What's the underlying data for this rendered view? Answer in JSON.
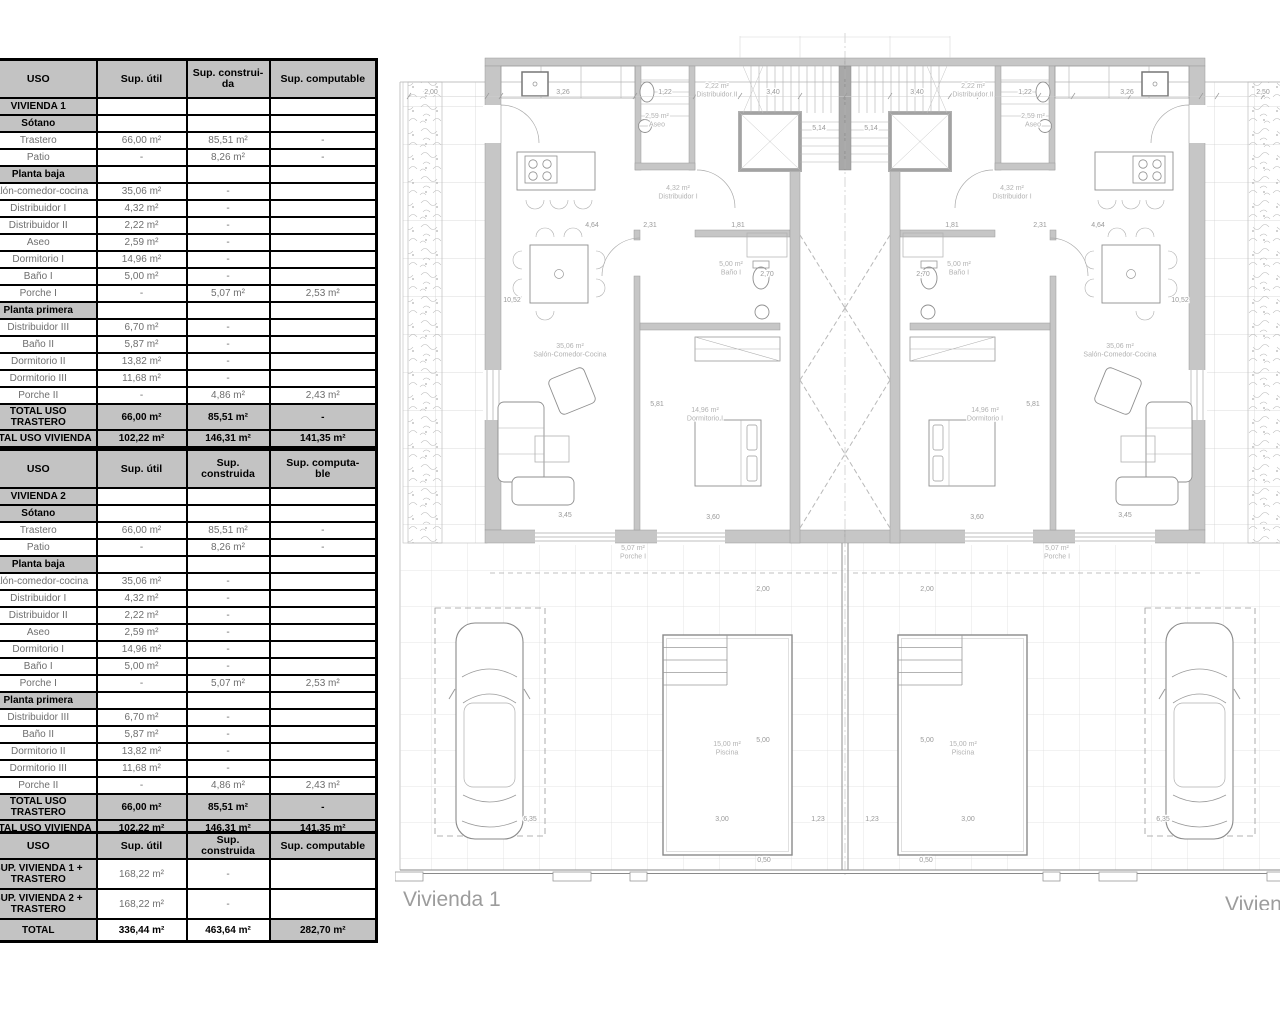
{
  "tables": [
    {
      "title": "VIVIENDA 1 areas",
      "headers": [
        "USO",
        "Sup. útil",
        "Sup. construi-\nda",
        "Sup. computable"
      ],
      "rows": [
        {
          "type": "section",
          "cells": [
            "VIVIENDA 1",
            "",
            "",
            ""
          ]
        },
        {
          "type": "sub",
          "cells": [
            "Sótano",
            "",
            "",
            ""
          ]
        },
        {
          "type": "data",
          "cells": [
            "Trastero",
            "66,00 m²",
            "85,51 m²",
            "-"
          ]
        },
        {
          "type": "data",
          "cells": [
            "Patio",
            "-",
            "8,26 m²",
            "-"
          ]
        },
        {
          "type": "sub",
          "cells": [
            "Planta baja",
            "",
            "",
            ""
          ]
        },
        {
          "type": "data",
          "cells": [
            "Salón-comedor-cocina",
            "35,06 m²",
            "-",
            ""
          ]
        },
        {
          "type": "data",
          "cells": [
            "Distribuidor I",
            "4,32 m²",
            "-",
            ""
          ]
        },
        {
          "type": "data",
          "cells": [
            "Distribuidor II",
            "2,22 m²",
            "-",
            ""
          ]
        },
        {
          "type": "data",
          "cells": [
            "Aseo",
            "2,59 m²",
            "-",
            ""
          ]
        },
        {
          "type": "data",
          "cells": [
            "Dormitorio I",
            "14,96 m²",
            "-",
            ""
          ]
        },
        {
          "type": "data",
          "cells": [
            "Baño I",
            "5,00 m²",
            "-",
            ""
          ]
        },
        {
          "type": "data",
          "cells": [
            "Porche I",
            "-",
            "5,07 m²",
            "2,53 m²"
          ]
        },
        {
          "type": "sub",
          "cells": [
            "Planta primera",
            "",
            "",
            ""
          ]
        },
        {
          "type": "data",
          "cells": [
            "Distribuidor III",
            "6,70 m²",
            "-",
            ""
          ]
        },
        {
          "type": "data",
          "cells": [
            "Baño II",
            "5,87 m²",
            "-",
            ""
          ]
        },
        {
          "type": "data",
          "cells": [
            "Dormitorio II",
            "13,82 m²",
            "-",
            ""
          ]
        },
        {
          "type": "data",
          "cells": [
            "Dormitorio III",
            "11,68 m²",
            "-",
            ""
          ]
        },
        {
          "type": "data",
          "cells": [
            "Porche II",
            "-",
            "4,86 m²",
            "2,43 m²"
          ]
        },
        {
          "type": "total",
          "cells": [
            "TOTAL USO TRASTERO",
            "66,00 m²",
            "85,51 m²",
            "-"
          ]
        },
        {
          "type": "total",
          "cells": [
            "TOTAL USO VIVIENDA",
            "102,22 m²",
            "146,31 m²",
            "141,35 m²"
          ]
        }
      ]
    },
    {
      "title": "VIVIENDA 2 areas",
      "headers": [
        "USO",
        "Sup. útil",
        "Sup. construida",
        "Sup. computa-\nble"
      ],
      "rows": [
        {
          "type": "section",
          "cells": [
            "VIVIENDA 2",
            "",
            "",
            ""
          ]
        },
        {
          "type": "sub",
          "cells": [
            "Sótano",
            "",
            "",
            ""
          ]
        },
        {
          "type": "data",
          "cells": [
            "Trastero",
            "66,00 m²",
            "85,51 m²",
            "-"
          ]
        },
        {
          "type": "data",
          "cells": [
            "Patio",
            "-",
            "8,26 m²",
            "-"
          ]
        },
        {
          "type": "sub",
          "cells": [
            "Planta baja",
            "",
            "",
            ""
          ]
        },
        {
          "type": "data",
          "cells": [
            "Salón-comedor-cocina",
            "35,06 m²",
            "-",
            ""
          ]
        },
        {
          "type": "data",
          "cells": [
            "Distribuidor I",
            "4,32 m²",
            "-",
            ""
          ]
        },
        {
          "type": "data",
          "cells": [
            "Distribuidor II",
            "2,22 m²",
            "-",
            ""
          ]
        },
        {
          "type": "data",
          "cells": [
            "Aseo",
            "2,59 m²",
            "-",
            ""
          ]
        },
        {
          "type": "data",
          "cells": [
            "Dormitorio I",
            "14,96 m²",
            "-",
            ""
          ]
        },
        {
          "type": "data",
          "cells": [
            "Baño I",
            "5,00 m²",
            "-",
            ""
          ]
        },
        {
          "type": "data",
          "cells": [
            "Porche I",
            "-",
            "5,07 m²",
            "2,53 m²"
          ]
        },
        {
          "type": "sub",
          "cells": [
            "Planta primera",
            "",
            "",
            ""
          ]
        },
        {
          "type": "data",
          "cells": [
            "Distribuidor III",
            "6,70 m²",
            "-",
            ""
          ]
        },
        {
          "type": "data",
          "cells": [
            "Baño II",
            "5,87 m²",
            "-",
            ""
          ]
        },
        {
          "type": "data",
          "cells": [
            "Dormitorio II",
            "13,82 m²",
            "-",
            ""
          ]
        },
        {
          "type": "data",
          "cells": [
            "Dormitorio III",
            "11,68 m²",
            "-",
            ""
          ]
        },
        {
          "type": "data",
          "cells": [
            "Porche II",
            "-",
            "4,86 m²",
            "2,43 m²"
          ]
        },
        {
          "type": "total",
          "cells": [
            "TOTAL USO TRASTERO",
            "66,00 m²",
            "85,51 m²",
            "-"
          ]
        },
        {
          "type": "total",
          "cells": [
            "TOTAL USO VIVIENDA",
            "102,22 m²",
            "146,31 m²",
            "141,35 m²"
          ]
        }
      ]
    },
    {
      "title": "Totales",
      "headers": [
        "USO",
        "Sup. útil",
        "Sup. construida",
        "Sup. computable"
      ],
      "rows": [
        {
          "type": "data2",
          "cells": [
            "SUP. VIVIENDA 1 +\nTRASTERO",
            "168,22 m²",
            "-",
            ""
          ]
        },
        {
          "type": "data2",
          "cells": [
            "SUP. VIVIENDA 2 +\nTRASTERO",
            "168,22 m²",
            "-",
            ""
          ]
        },
        {
          "type": "grandtotal",
          "cells": [
            "TOTAL",
            "336,44 m²",
            "463,64  m²",
            "282,70  m²"
          ]
        }
      ]
    }
  ],
  "plan": {
    "dwelling_1_label": "Vivienda 1",
    "dwelling_2_label": "Vivienda 2",
    "texts": [
      {
        "t": "2,00",
        "x": 36,
        "y": 64,
        "c": "dim"
      },
      {
        "t": "3,26",
        "x": 168,
        "y": 64,
        "c": "dim"
      },
      {
        "t": "1,22",
        "x": 270,
        "y": 64,
        "c": "dim"
      },
      {
        "t": "2,22 m²\nDistribuidor II",
        "x": 322,
        "y": 58,
        "c": "room"
      },
      {
        "t": "3,40",
        "x": 378,
        "y": 64,
        "c": "dim"
      },
      {
        "t": "3,40",
        "x": 522,
        "y": 64,
        "c": "dim"
      },
      {
        "t": "2,22 m²\nDistribuidor II",
        "x": 578,
        "y": 58,
        "c": "room"
      },
      {
        "t": "1,22",
        "x": 630,
        "y": 64,
        "c": "dim"
      },
      {
        "t": "3,26",
        "x": 732,
        "y": 64,
        "c": "dim"
      },
      {
        "t": "2,50",
        "x": 868,
        "y": 64,
        "c": "dim"
      },
      {
        "t": "5,14",
        "x": 424,
        "y": 100,
        "c": "dim"
      },
      {
        "t": "5,14",
        "x": 476,
        "y": 100,
        "c": "dim"
      },
      {
        "t": "2,59 m²\nAseo",
        "x": 262,
        "y": 88,
        "c": "room"
      },
      {
        "t": "2,59 m²\nAseo",
        "x": 638,
        "y": 88,
        "c": "room"
      },
      {
        "t": "4,32 m²\nDistribuidor I",
        "x": 283,
        "y": 160,
        "c": "room"
      },
      {
        "t": "4,32 m²\nDistribuidor I",
        "x": 617,
        "y": 160,
        "c": "room"
      },
      {
        "t": "4,64",
        "x": 197,
        "y": 197,
        "c": "dim"
      },
      {
        "t": "2,31",
        "x": 255,
        "y": 197,
        "c": "dim"
      },
      {
        "t": "1,81",
        "x": 343,
        "y": 197,
        "c": "dim"
      },
      {
        "t": "1,81",
        "x": 557,
        "y": 197,
        "c": "dim"
      },
      {
        "t": "2,31",
        "x": 645,
        "y": 197,
        "c": "dim"
      },
      {
        "t": "4,64",
        "x": 703,
        "y": 197,
        "c": "dim"
      },
      {
        "t": "10,52",
        "x": 117,
        "y": 272,
        "c": "dim"
      },
      {
        "t": "10,52",
        "x": 785,
        "y": 272,
        "c": "dim"
      },
      {
        "t": "5,00 m²\nBaño I",
        "x": 336,
        "y": 236,
        "c": "room"
      },
      {
        "t": "2,70",
        "x": 372,
        "y": 246,
        "c": "dim"
      },
      {
        "t": "2,70",
        "x": 528,
        "y": 246,
        "c": "dim"
      },
      {
        "t": "5,00 m²\nBaño I",
        "x": 564,
        "y": 236,
        "c": "room"
      },
      {
        "t": "35,06 m²\nSalón-Comedor-Cocina",
        "x": 175,
        "y": 318,
        "c": "room"
      },
      {
        "t": "35,06 m²\nSalón-Comedor-Cocina",
        "x": 725,
        "y": 318,
        "c": "room"
      },
      {
        "t": "14,96 m²\nDormitorio I",
        "x": 310,
        "y": 382,
        "c": "room"
      },
      {
        "t": "14,96 m²\nDormitorio I",
        "x": 590,
        "y": 382,
        "c": "room"
      },
      {
        "t": "5,81",
        "x": 262,
        "y": 376,
        "c": "dim"
      },
      {
        "t": "5,81",
        "x": 638,
        "y": 376,
        "c": "dim"
      },
      {
        "t": "3,45",
        "x": 170,
        "y": 487,
        "c": "dim"
      },
      {
        "t": "3,60",
        "x": 318,
        "y": 489,
        "c": "dim"
      },
      {
        "t": "3,60",
        "x": 582,
        "y": 489,
        "c": "dim"
      },
      {
        "t": "3,45",
        "x": 730,
        "y": 487,
        "c": "dim"
      },
      {
        "t": "5,07 m²\nPorche I",
        "x": 238,
        "y": 520,
        "c": "room"
      },
      {
        "t": "5,07 m²\nPorche I",
        "x": 662,
        "y": 520,
        "c": "room"
      },
      {
        "t": "2,00",
        "x": 368,
        "y": 561,
        "c": "dim"
      },
      {
        "t": "2,00",
        "x": 532,
        "y": 561,
        "c": "dim"
      },
      {
        "t": "5,00",
        "x": 368,
        "y": 712,
        "c": "dim"
      },
      {
        "t": "5,00",
        "x": 532,
        "y": 712,
        "c": "dim"
      },
      {
        "t": "15,00 m²\nPiscina",
        "x": 332,
        "y": 716,
        "c": "room"
      },
      {
        "t": "15,00 m²\nPiscina",
        "x": 568,
        "y": 716,
        "c": "room"
      },
      {
        "t": "6,35",
        "x": 135,
        "y": 791,
        "c": "dim"
      },
      {
        "t": "3,00",
        "x": 327,
        "y": 791,
        "c": "dim"
      },
      {
        "t": "1,23",
        "x": 423,
        "y": 791,
        "c": "dim"
      },
      {
        "t": "1,23",
        "x": 477,
        "y": 791,
        "c": "dim"
      },
      {
        "t": "3,00",
        "x": 573,
        "y": 791,
        "c": "dim"
      },
      {
        "t": "6,35",
        "x": 768,
        "y": 791,
        "c": "dim"
      },
      {
        "t": "0,50",
        "x": 369,
        "y": 832,
        "c": "dim"
      },
      {
        "t": "0,50",
        "x": 531,
        "y": 832,
        "c": "dim"
      },
      {
        "t": "Vivienda 1",
        "x": 8,
        "y": 876,
        "c": "big",
        "a": "start"
      },
      {
        "t": "Vivienda 2",
        "x": 830,
        "y": 881,
        "c": "big",
        "a": "start"
      }
    ]
  }
}
